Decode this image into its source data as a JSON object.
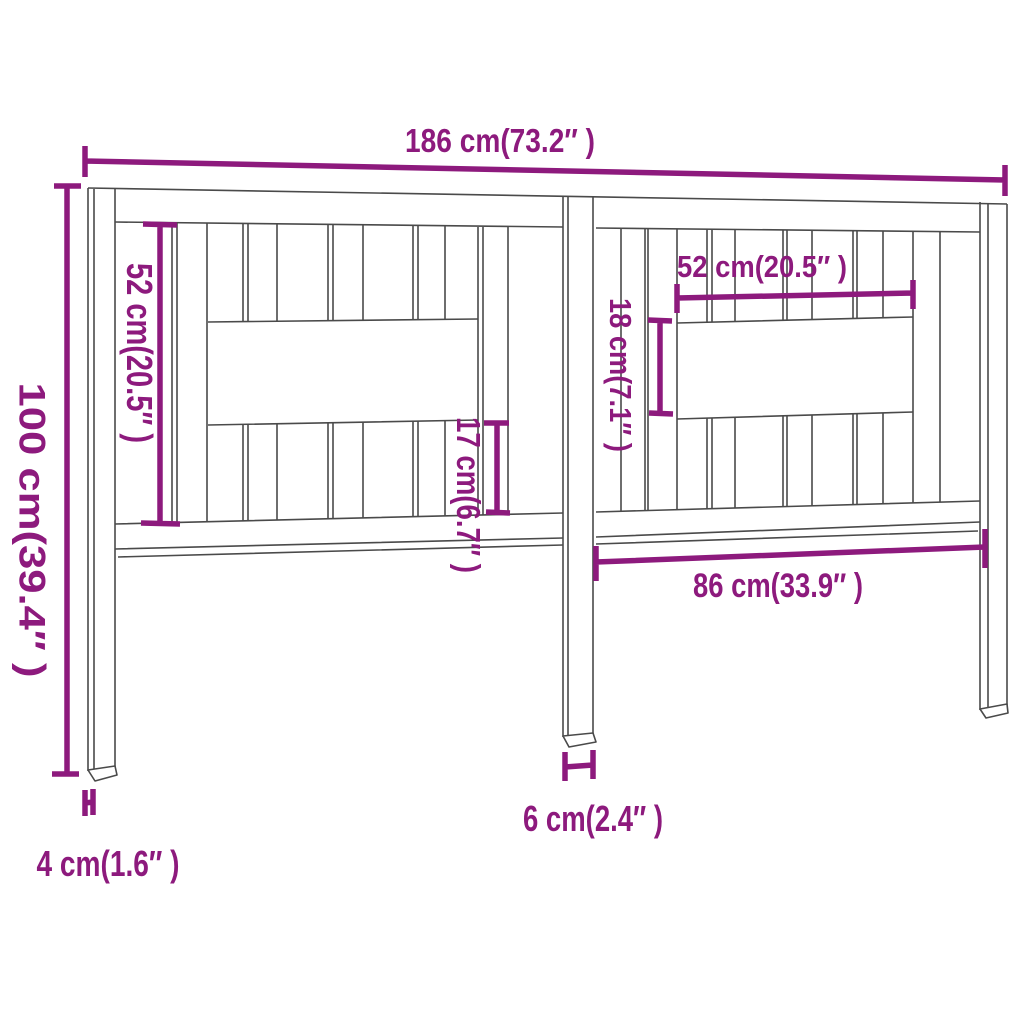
{
  "colors": {
    "dimension_purple": "#8D1A7D",
    "outline_gray": "#4A4A4A",
    "background": "#FFFFFF"
  },
  "labels": {
    "total_width": "186 cm(73.2″ )",
    "total_height": "100 cm(39.4″ )",
    "left_panel_height": "52 cm(20.5″ )",
    "center_lower_height": "17 cm(6.7″ )",
    "right_opening_width": "52 cm(20.5″ )",
    "right_opening_height": "18 cm(7.1″ )",
    "leg_span": "86 cm(33.9″ )",
    "center_leg_width": "6 cm(2.4″ )",
    "outer_leg_width": "4 cm(1.6″ )"
  }
}
